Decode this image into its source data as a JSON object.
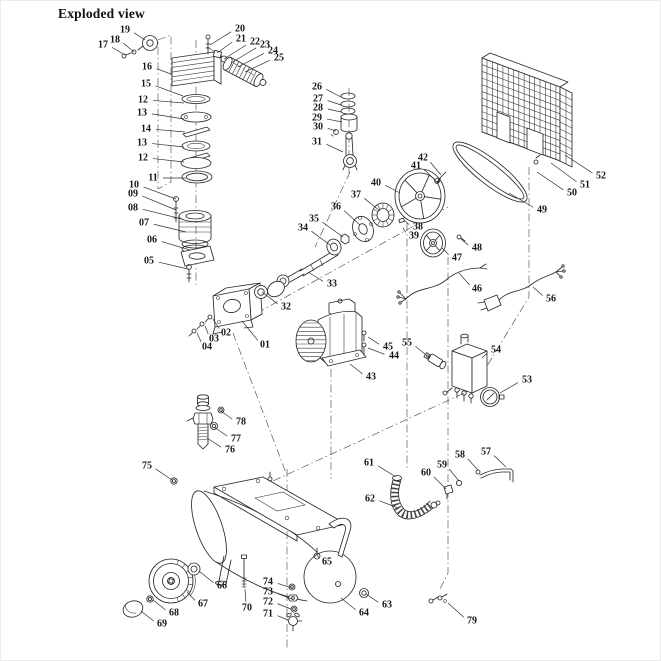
{
  "title": "Exploded view",
  "diagram": {
    "type": "exploded-parts-diagram",
    "subject": "belt-driven air compressor",
    "background": "#ffffff",
    "ink_color": "#2a2a2a",
    "leader_color": "#303030",
    "part_numbers_range": "01-79",
    "part_labels": [
      {
        "n": "19",
        "x": 125,
        "y": 30,
        "tx": 145,
        "ty": 40
      },
      {
        "n": "17",
        "x": 103,
        "y": 45,
        "tx": 125,
        "ty": 55
      },
      {
        "n": "18",
        "x": 115,
        "y": 40,
        "tx": 134,
        "ty": 52
      },
      {
        "n": "16",
        "x": 147,
        "y": 67,
        "tx": 171,
        "ty": 74
      },
      {
        "n": "15",
        "x": 146,
        "y": 84,
        "tx": 183,
        "ty": 96
      },
      {
        "n": "12",
        "x": 143,
        "y": 100,
        "tx": 184,
        "ty": 103
      },
      {
        "n": "13",
        "x": 142,
        "y": 113,
        "tx": 184,
        "ty": 119
      },
      {
        "n": "14",
        "x": 146,
        "y": 129,
        "tx": 185,
        "ty": 132
      },
      {
        "n": "13",
        "x": 142,
        "y": 143,
        "tx": 184,
        "ty": 147
      },
      {
        "n": "12",
        "x": 143,
        "y": 158,
        "tx": 184,
        "ty": 162
      },
      {
        "n": "11",
        "x": 153,
        "y": 178,
        "tx": 186,
        "ty": 178
      },
      {
        "n": "10",
        "x": 134,
        "y": 185,
        "tx": 176,
        "ty": 199
      },
      {
        "n": "09",
        "x": 133,
        "y": 194,
        "tx": 176,
        "ty": 210
      },
      {
        "n": "08",
        "x": 133,
        "y": 208,
        "tx": 182,
        "ty": 219
      },
      {
        "n": "07",
        "x": 144,
        "y": 223,
        "tx": 186,
        "ty": 232
      },
      {
        "n": "06",
        "x": 152,
        "y": 240,
        "tx": 190,
        "ty": 250
      },
      {
        "n": "05",
        "x": 149,
        "y": 261,
        "tx": 188,
        "ty": 269
      },
      {
        "n": "20",
        "x": 240,
        "y": 29,
        "tx": 210,
        "ty": 45
      },
      {
        "n": "21",
        "x": 241,
        "y": 39,
        "tx": 217,
        "ty": 53
      },
      {
        "n": "22",
        "x": 255,
        "y": 42,
        "tx": 224,
        "ty": 59
      },
      {
        "n": "23",
        "x": 265,
        "y": 45,
        "tx": 231,
        "ty": 63
      },
      {
        "n": "24",
        "x": 273,
        "y": 51,
        "tx": 238,
        "ty": 67
      },
      {
        "n": "25",
        "x": 279,
        "y": 58,
        "tx": 245,
        "ty": 72
      },
      {
        "n": "26",
        "x": 317,
        "y": 87,
        "tx": 341,
        "ty": 97
      },
      {
        "n": "27",
        "x": 318,
        "y": 99,
        "tx": 341,
        "ty": 105
      },
      {
        "n": "28",
        "x": 318,
        "y": 108,
        "tx": 341,
        "ty": 112
      },
      {
        "n": "29",
        "x": 317,
        "y": 118,
        "tx": 342,
        "ty": 122
      },
      {
        "n": "30",
        "x": 318,
        "y": 127,
        "tx": 336,
        "ty": 131
      },
      {
        "n": "31",
        "x": 317,
        "y": 142,
        "tx": 343,
        "ty": 152
      },
      {
        "n": "32",
        "x": 286,
        "y": 307,
        "tx": 262,
        "ty": 292
      },
      {
        "n": "33",
        "x": 332,
        "y": 284,
        "tx": 308,
        "ty": 272
      },
      {
        "n": "34",
        "x": 303,
        "y": 228,
        "tx": 330,
        "ty": 245
      },
      {
        "n": "35",
        "x": 314,
        "y": 219,
        "tx": 343,
        "ty": 237
      },
      {
        "n": "36",
        "x": 336,
        "y": 207,
        "tx": 360,
        "ty": 225
      },
      {
        "n": "37",
        "x": 356,
        "y": 195,
        "tx": 380,
        "ty": 211
      },
      {
        "n": "38",
        "x": 418,
        "y": 227,
        "tx": 405,
        "ty": 221
      },
      {
        "n": "39",
        "x": 414,
        "y": 236,
        "tx": 403,
        "ty": 228
      },
      {
        "n": "40",
        "x": 376,
        "y": 183,
        "tx": 400,
        "ty": 193
      },
      {
        "n": "41",
        "x": 416,
        "y": 166,
        "tx": 434,
        "ty": 179
      },
      {
        "n": "42",
        "x": 423,
        "y": 158,
        "tx": 441,
        "ty": 175
      },
      {
        "n": "01",
        "x": 265,
        "y": 345,
        "tx": 242,
        "ty": 321
      },
      {
        "n": "02",
        "x": 226,
        "y": 333,
        "tx": 213,
        "ty": 319
      },
      {
        "n": "03",
        "x": 214,
        "y": 339,
        "tx": 205,
        "ty": 326
      },
      {
        "n": "04",
        "x": 207,
        "y": 347,
        "tx": 197,
        "ty": 333
      },
      {
        "n": "43",
        "x": 371,
        "y": 377,
        "tx": 350,
        "ty": 364
      },
      {
        "n": "44",
        "x": 394,
        "y": 356,
        "tx": 368,
        "ty": 348
      },
      {
        "n": "45",
        "x": 388,
        "y": 347,
        "tx": 368,
        "ty": 337
      },
      {
        "n": "55",
        "x": 407,
        "y": 343,
        "tx": 430,
        "ty": 358
      },
      {
        "n": "46",
        "x": 477,
        "y": 289,
        "tx": 459,
        "ty": 273
      },
      {
        "n": "47",
        "x": 457,
        "y": 258,
        "tx": 442,
        "ty": 248
      },
      {
        "n": "48",
        "x": 477,
        "y": 248,
        "tx": 461,
        "ty": 239
      },
      {
        "n": "49",
        "x": 542,
        "y": 210,
        "tx": 509,
        "ty": 193
      },
      {
        "n": "50",
        "x": 572,
        "y": 193,
        "tx": 537,
        "ty": 172
      },
      {
        "n": "51",
        "x": 585,
        "y": 185,
        "tx": 551,
        "ty": 163
      },
      {
        "n": "52",
        "x": 601,
        "y": 176,
        "tx": 565,
        "ty": 155
      },
      {
        "n": "53",
        "x": 527,
        "y": 380,
        "tx": 500,
        "ty": 393
      },
      {
        "n": "54",
        "x": 496,
        "y": 350,
        "tx": 482,
        "ty": 358
      },
      {
        "n": "56",
        "x": 551,
        "y": 299,
        "tx": 533,
        "ty": 287
      },
      {
        "n": "57",
        "x": 486,
        "y": 452,
        "tx": 506,
        "ty": 467
      },
      {
        "n": "58",
        "x": 460,
        "y": 455,
        "tx": 478,
        "ty": 470
      },
      {
        "n": "59",
        "x": 442,
        "y": 465,
        "tx": 459,
        "ty": 481
      },
      {
        "n": "60",
        "x": 426,
        "y": 473,
        "tx": 446,
        "ty": 489
      },
      {
        "n": "61",
        "x": 369,
        "y": 463,
        "tx": 396,
        "ty": 477
      },
      {
        "n": "62",
        "x": 370,
        "y": 499,
        "tx": 398,
        "ty": 508
      },
      {
        "n": "63",
        "x": 387,
        "y": 605,
        "tx": 366,
        "ty": 594
      },
      {
        "n": "64",
        "x": 364,
        "y": 613,
        "tx": 341,
        "ty": 598
      },
      {
        "n": "65",
        "x": 327,
        "y": 562,
        "tx": 316,
        "ty": 553
      },
      {
        "n": "66",
        "x": 222,
        "y": 586,
        "tx": 199,
        "ty": 571
      },
      {
        "n": "67",
        "x": 203,
        "y": 604,
        "tx": 187,
        "ty": 592
      },
      {
        "n": "68",
        "x": 174,
        "y": 613,
        "tx": 153,
        "ty": 600
      },
      {
        "n": "69",
        "x": 162,
        "y": 624,
        "tx": 141,
        "ty": 611
      },
      {
        "n": "70",
        "x": 247,
        "y": 608,
        "tx": 245,
        "ty": 589
      },
      {
        "n": "71",
        "x": 268,
        "y": 614,
        "tx": 288,
        "ty": 620
      },
      {
        "n": "72",
        "x": 268,
        "y": 602,
        "tx": 291,
        "ty": 609
      },
      {
        "n": "73",
        "x": 268,
        "y": 592,
        "tx": 292,
        "ty": 599
      },
      {
        "n": "74",
        "x": 268,
        "y": 582,
        "tx": 292,
        "ty": 588
      },
      {
        "n": "75",
        "x": 147,
        "y": 466,
        "tx": 172,
        "ty": 480
      },
      {
        "n": "76",
        "x": 230,
        "y": 450,
        "tx": 207,
        "ty": 438
      },
      {
        "n": "77",
        "x": 236,
        "y": 439,
        "tx": 214,
        "ty": 427
      },
      {
        "n": "78",
        "x": 241,
        "y": 422,
        "tx": 221,
        "ty": 411
      },
      {
        "n": "79",
        "x": 472,
        "y": 621,
        "tx": 448,
        "ty": 603
      }
    ]
  }
}
